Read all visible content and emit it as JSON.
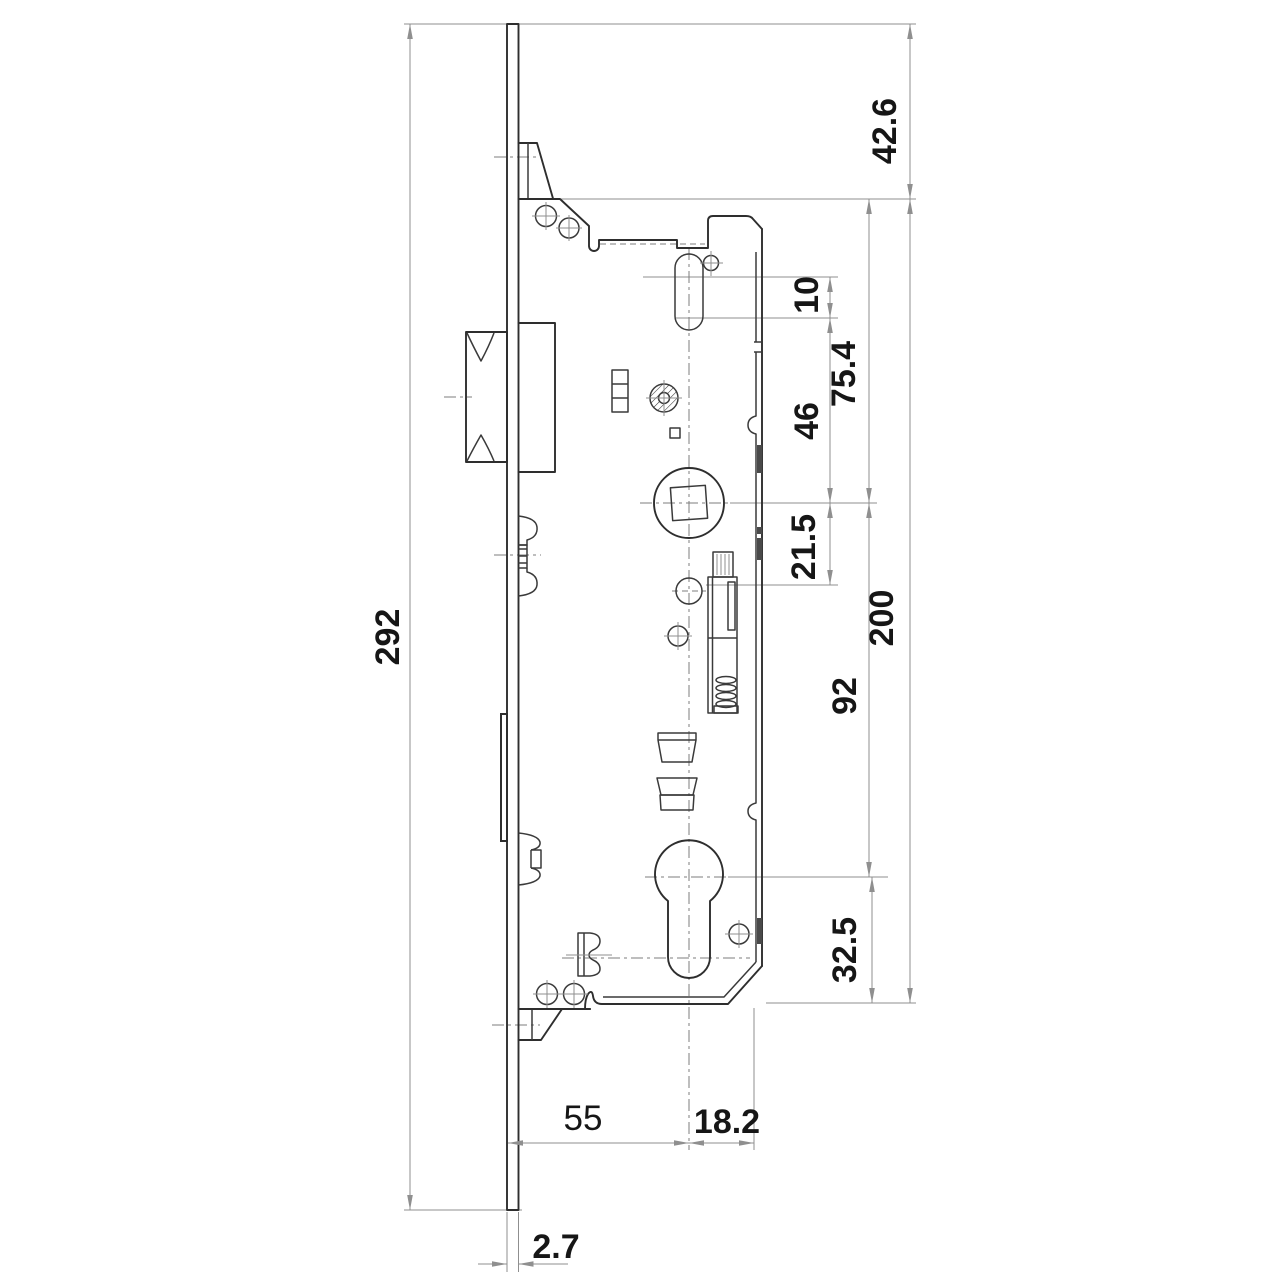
{
  "colors": {
    "background": "#ffffff",
    "outline": "#2e2e2e",
    "dimension_lines": "#8f8f8f",
    "label_text": "#161616",
    "backset_label_color": "#1e2f55"
  },
  "dimensions": {
    "overall_height": {
      "label": "292"
    },
    "top_to_case": {
      "label": "42.6"
    },
    "slot_travel": {
      "label": "10"
    },
    "case_top_to_spindle": {
      "label": "75.4"
    },
    "slot_to_spindle": {
      "label": "46"
    },
    "spindle_to_follower": {
      "label": "21.5"
    },
    "case_height": {
      "label": "200"
    },
    "spindle_to_cylinder": {
      "label": "92"
    },
    "cylinder_to_case_bottom": {
      "label": "32.5"
    },
    "backset": {
      "label": "55"
    },
    "cylinder_to_case_edge": {
      "label": "18.2"
    },
    "faceplate_thickness": {
      "label": "2.7"
    }
  }
}
